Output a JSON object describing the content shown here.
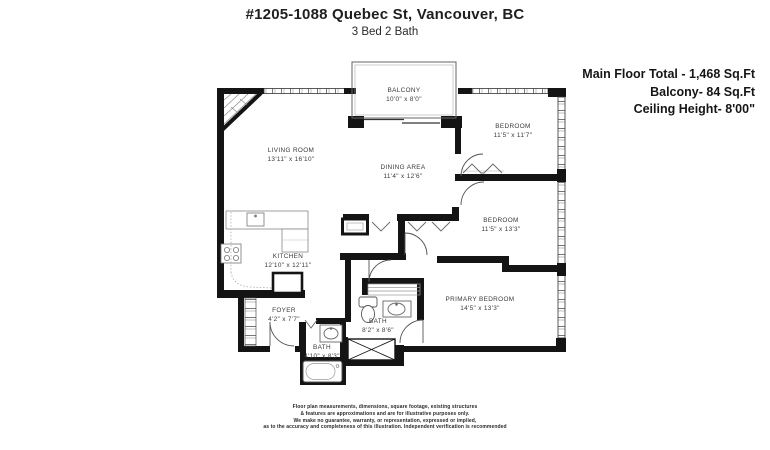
{
  "header": {
    "title": "#1205-1088 Quebec St, Vancouver, BC",
    "subtitle": "3 Bed 2 Bath"
  },
  "info": {
    "main_floor": "Main Floor Total - 1,468 Sq.Ft",
    "balcony": "Balcony- 84 Sq.Ft",
    "ceiling": "Ceiling Height- 8'00\""
  },
  "rooms": {
    "balcony": {
      "name": "BALCONY",
      "dims": "10'0\" x 8'0\""
    },
    "living": {
      "name": "LIVING ROOM",
      "dims": "13'11\" x 16'10\""
    },
    "dining": {
      "name": "DINING AREA",
      "dims": "11'4\" x 12'6\""
    },
    "bedroom1": {
      "name": "BEDROOM",
      "dims": "11'5\" x 11'7\""
    },
    "bedroom2": {
      "name": "BEDROOM",
      "dims": "11'5\" x 13'3\""
    },
    "primary": {
      "name": "PRIMARY BEDROOM",
      "dims": "14'5\" x 13'3\""
    },
    "kitchen": {
      "name": "KITCHEN",
      "dims": "12'10\" x 12'11\""
    },
    "foyer": {
      "name": "FOYER",
      "dims": "4'2\" x 7'7\""
    },
    "bath_main": {
      "name": "BATH",
      "dims": "8'2\" x 8'6\""
    },
    "bath_ensuite": {
      "name": "BATH",
      "dims": "4'10\" x 8'3\""
    }
  },
  "disclaimer": {
    "line1": "Floor plan measurements, dimensions, square footage, existing structures",
    "line2": "& features are approximations and are for illustrative purposes only.",
    "line3": "We make no guarantee, warranty, or representation, expressed or implied,",
    "line4": "as to the accuracy and completeness of this illustration. Independent verification is recommended"
  },
  "colors": {
    "wall": "#141414",
    "text": "#333333"
  }
}
